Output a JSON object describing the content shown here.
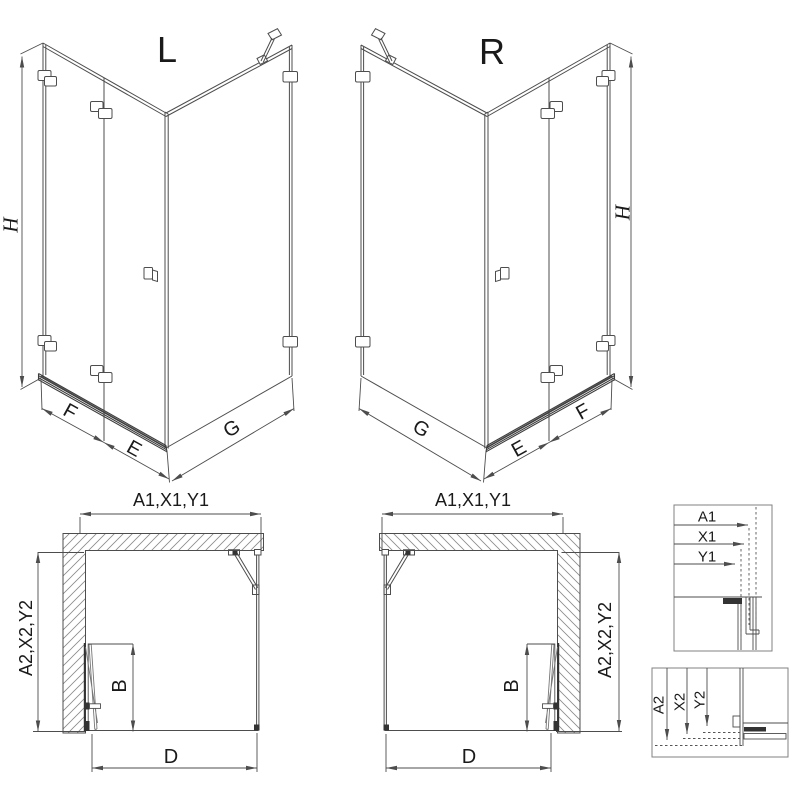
{
  "sheet": {
    "description_labels_only": true
  },
  "iso_views": [
    {
      "id": "left",
      "variant": "L",
      "height": "H",
      "panel_fixed": "F",
      "panel_door": "E",
      "panel_side": "G"
    },
    {
      "id": "right",
      "variant": "R",
      "height": "H",
      "panel_fixed": "F",
      "panel_door": "E",
      "panel_side": "G"
    }
  ],
  "plan_views": [
    {
      "id": "left",
      "width_dims": "A1,X1,Y1",
      "depth_dims": "A2,X2,Y2",
      "door_width": "B",
      "front_width": "D"
    },
    {
      "id": "right",
      "width_dims": "A1,X1,Y1",
      "depth_dims": "A2,X2,Y2",
      "door_width": "B",
      "front_width": "D"
    }
  ],
  "detail_views": [
    {
      "id": "width-adjustment",
      "dims": [
        "A1",
        "X1",
        "Y1"
      ]
    },
    {
      "id": "depth-adjustment",
      "dims": [
        "A2",
        "X2",
        "Y2"
      ]
    }
  ],
  "colors": {
    "line": "#4d4d4d",
    "dark": "#333333",
    "hatch": "#8a8a8a",
    "text": "#1a1a1a",
    "frame": "#808080",
    "background": "#ffffff"
  }
}
